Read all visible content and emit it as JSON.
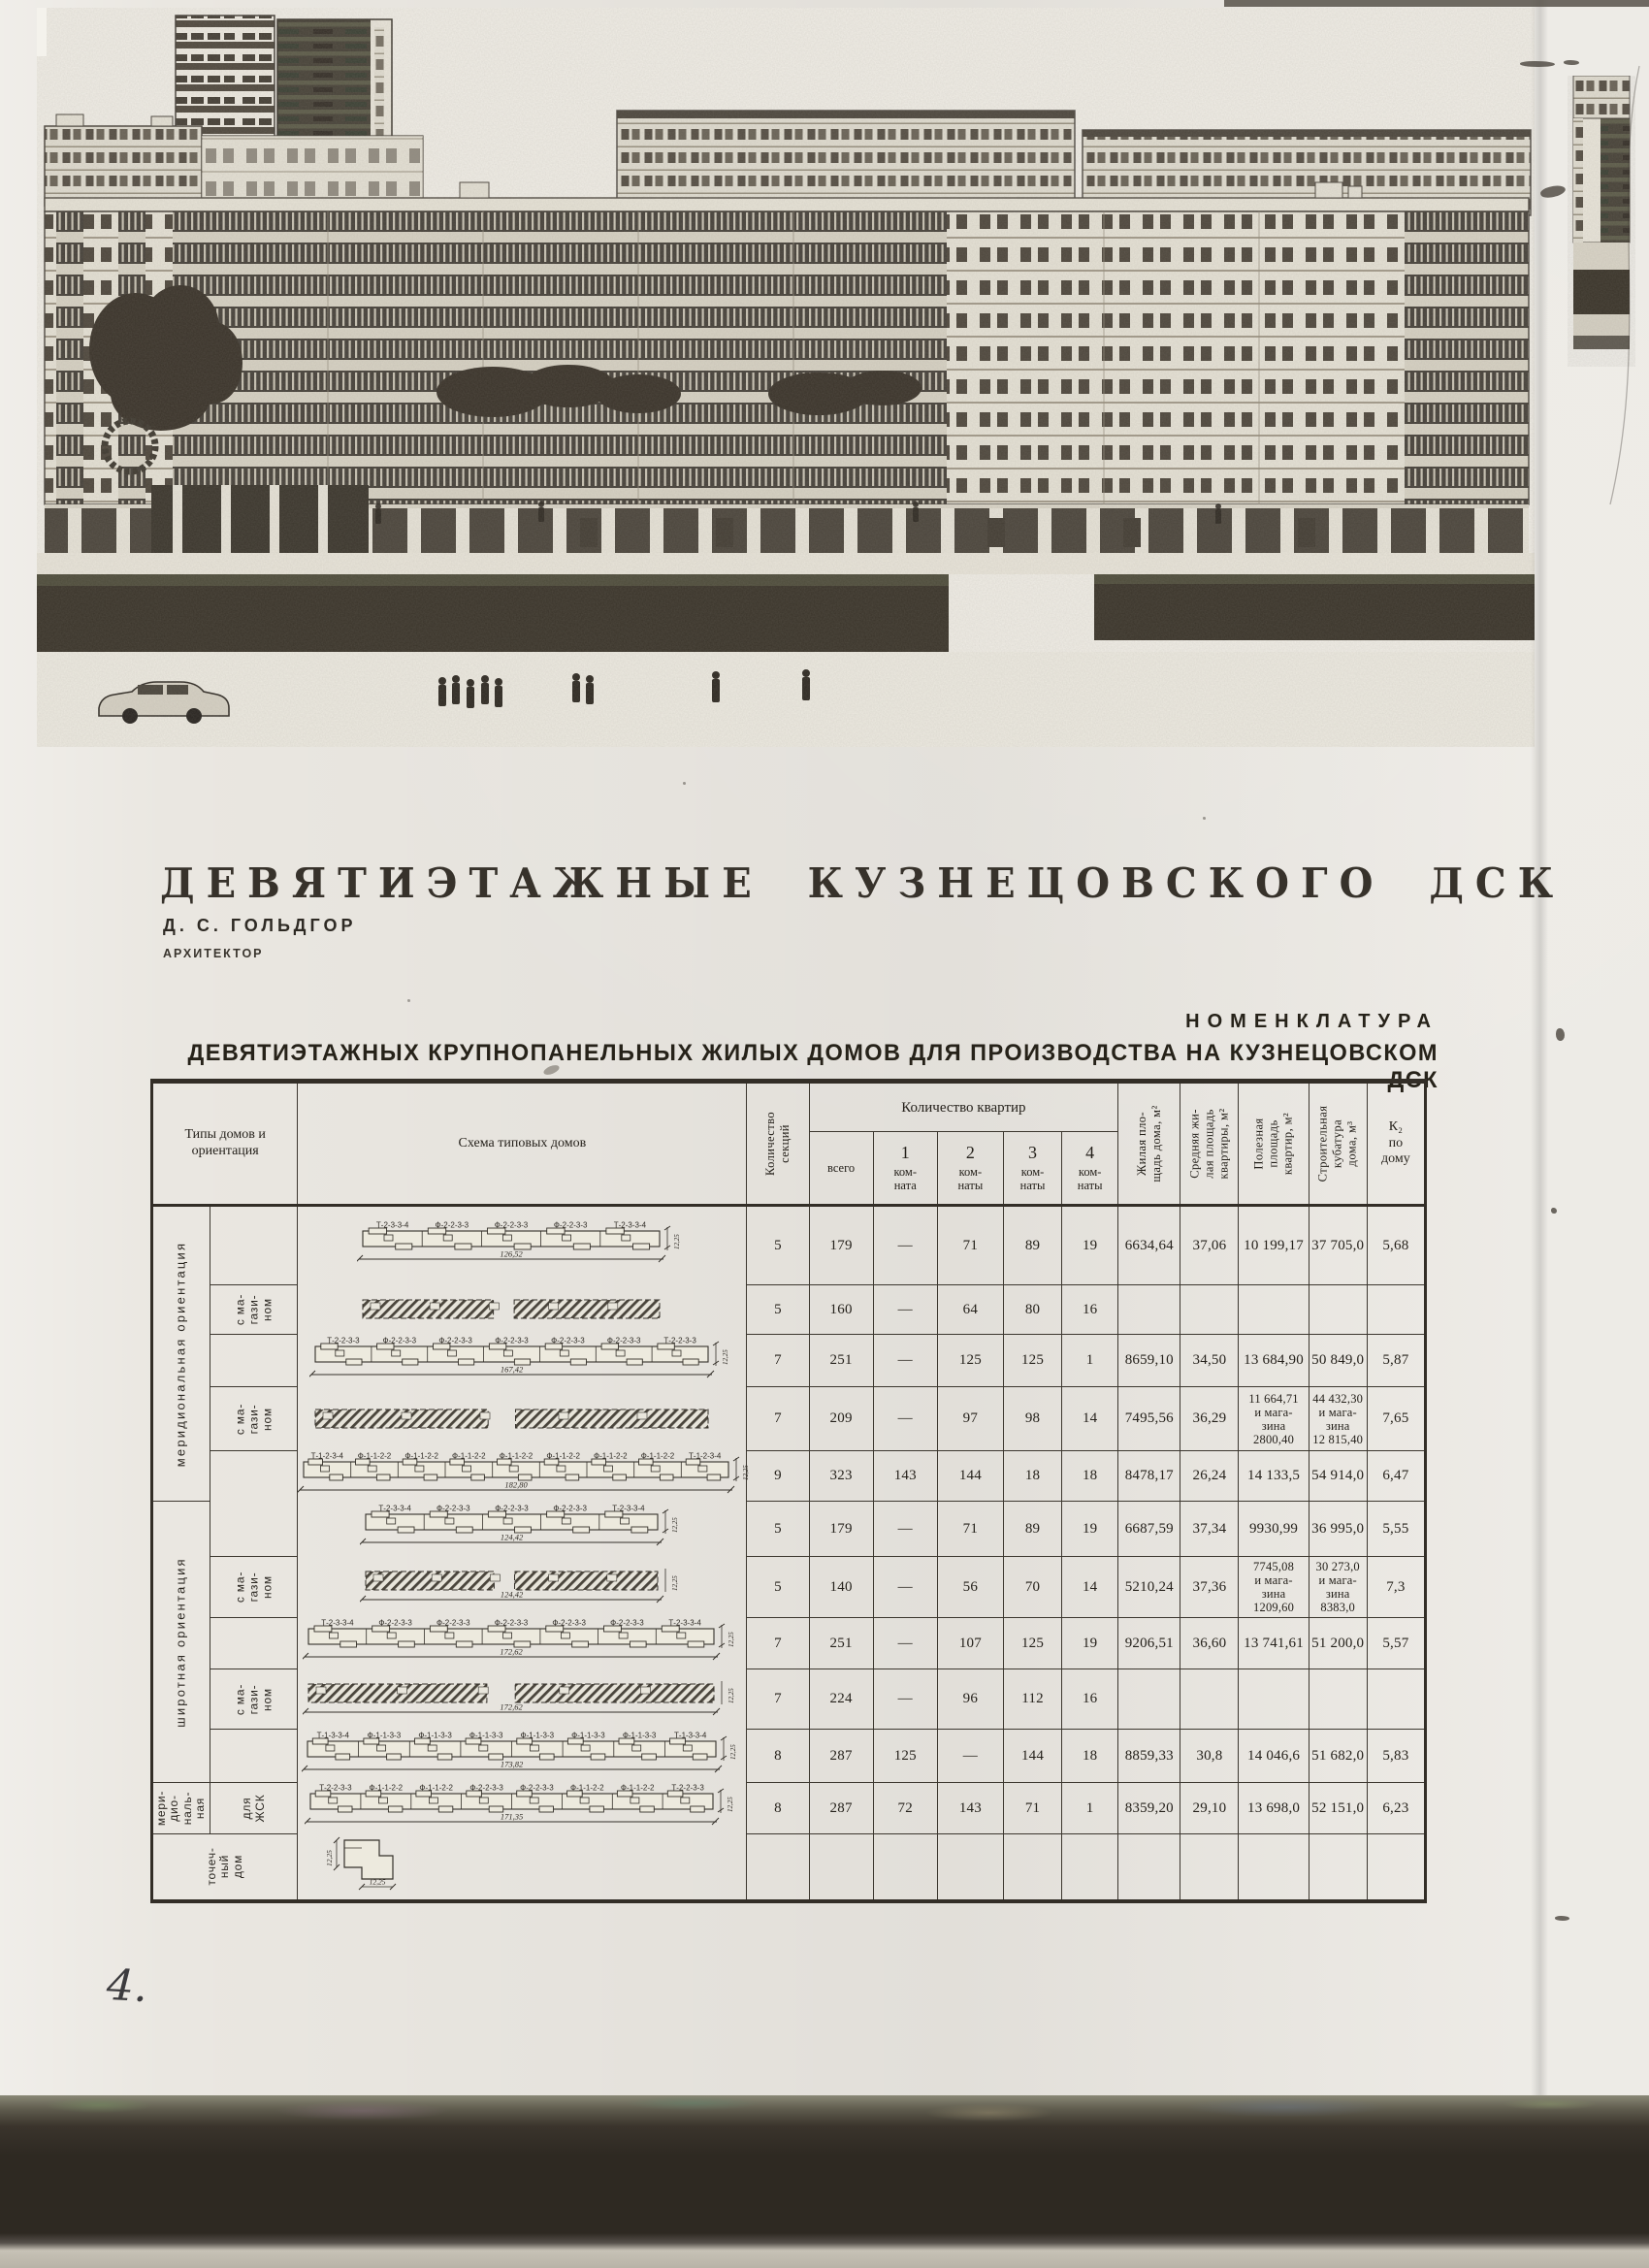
{
  "page": {
    "handwritten_number": "4.",
    "colors": {
      "paper": "#eae7e1",
      "ink": "#2c2824",
      "table_line": "#3c372f",
      "scan_band": "#2e2922",
      "photo_dark": "#46413a",
      "photo_light": "#e6e2d6"
    }
  },
  "title": "ДЕВЯТИЭТАЖНЫЕ КУЗНЕЦОВСКОГО ДСК",
  "author": {
    "name": "Д. С. ГОЛЬДГОР",
    "role": "АРХИТЕКТОР"
  },
  "nomenclature": {
    "heading": "НОМЕНКЛАТУРА",
    "subheading": "ДЕВЯТИЭТАЖНЫХ КРУПНОПАНЕЛЬНЫХ ЖИЛЫХ ДОМОВ ДЛЯ ПРОИЗВОДСТВА НА КУЗНЕЦОВСКОМ ДСК"
  },
  "table": {
    "headers": {
      "types": "Типы домов и\nориентация",
      "scheme": "Схема типовых домов",
      "sections": "Количество\nсекций",
      "apartments_group": "Количество квартир",
      "apartments": [
        "всего",
        "1\nком-\nната",
        "2\nком-\nнаты",
        "3\nком-\nнаты",
        "4\nком-\nнаты"
      ],
      "living_area": "Жилая пло-\nщадь дома, м²",
      "avg_area": "Средняя жи-\nлая площадь\nквартиры, м²",
      "useful_area": "Полезная\nплощадь\nквартир, м²",
      "volume": "Строительная\nкубатура\nдома, м³",
      "k2": "К₂\nпо\nдому"
    },
    "groups": [
      {
        "label": "меридиональная ориентация",
        "rows": [
          0,
          4
        ]
      },
      {
        "label": "широтная ориентация",
        "rows": [
          5,
          9
        ]
      },
      {
        "label": "мери-\nдио-\nналь-\nная",
        "rows": [
          10,
          10
        ]
      },
      {
        "label": "точеч-\nный\nдом",
        "rows": [
          11,
          11
        ],
        "full": true
      }
    ],
    "rows": [
      {
        "sub": "",
        "scheme": {
          "kind": "plan",
          "labels": [
            "Т-2-3-3-4",
            "Ф-2-2-3-3",
            "Ф-2-2-3-3",
            "Ф-2-2-3-3",
            "Т-2-3-3-4"
          ],
          "length": "126,52",
          "depth": "12,25"
        },
        "values": [
          "5",
          "179",
          "—",
          "71",
          "89",
          "19",
          "6634,64",
          "37,06",
          "10 199,17",
          "37 705,0",
          "5,68"
        ]
      },
      {
        "sub": "с ма-\nгази-\nном",
        "scheme": {
          "kind": "hatched"
        },
        "values": [
          "5",
          "160",
          "—",
          "64",
          "80",
          "16",
          "",
          "",
          "",
          "",
          ""
        ]
      },
      {
        "sub": "",
        "scheme": {
          "kind": "plan",
          "labels": [
            "Т-2-2-3-3",
            "Ф-2-2-3-3",
            "Ф-2-2-3-3",
            "Ф-2-2-3-3",
            "Ф-2-2-3-3",
            "Ф-2-2-3-3",
            "Т-2-2-3-3"
          ],
          "length": "167,42",
          "depth": "12,25"
        },
        "values": [
          "7",
          "251",
          "—",
          "125",
          "125",
          "1",
          "8659,10",
          "34,50",
          "13 684,90",
          "50 849,0",
          "5,87"
        ]
      },
      {
        "sub": "с ма-\nгази-\nном",
        "scheme": {
          "kind": "hatched"
        },
        "values": [
          "7",
          "209",
          "—",
          "97",
          "98",
          "14",
          "7495,56",
          "36,29",
          "11 664,71\nи мага-\nзина\n2800,40",
          "44 432,30\nи мага-\nзина\n12 815,40",
          "7,65"
        ]
      },
      {
        "sub": "",
        "scheme": {
          "kind": "plan",
          "labels": [
            "Т-1-2-3-4",
            "Ф-1-1-2-2",
            "Ф-1-1-2-2",
            "Ф-1-1-2-2",
            "Ф-1-1-2-2",
            "Ф-1-1-2-2",
            "Ф-1-1-2-2",
            "Ф-1-1-2-2",
            "Т-1-2-3-4"
          ],
          "length": "182,80",
          "depth": "12,25"
        },
        "values": [
          "9",
          "323",
          "143",
          "144",
          "18",
          "18",
          "8478,17",
          "26,24",
          "14 133,5",
          "54 914,0",
          "6,47"
        ]
      },
      {
        "sub": "",
        "scheme": {
          "kind": "plan",
          "labels": [
            "Т-2-3-3-4",
            "Ф-2-2-3-3",
            "Ф-2-2-3-3",
            "Ф-2-2-3-3",
            "Т-2-3-3-4"
          ],
          "length": "124,42",
          "depth": "12,25"
        },
        "values": [
          "5",
          "179",
          "—",
          "71",
          "89",
          "19",
          "6687,59",
          "37,34",
          "9930,99",
          "36 995,0",
          "5,55"
        ]
      },
      {
        "sub": "с ма-\nгази-\nном",
        "scheme": {
          "kind": "hatched",
          "length": "124,42",
          "depth": "12,25"
        },
        "values": [
          "5",
          "140",
          "—",
          "56",
          "70",
          "14",
          "5210,24",
          "37,36",
          "7745,08\nи мага-\nзина\n1209,60",
          "30 273,0\nи мага-\nзина\n8383,0",
          "7,3"
        ]
      },
      {
        "sub": "",
        "scheme": {
          "kind": "plan",
          "labels": [
            "Т-2-3-3-4",
            "Ф-2-2-3-3",
            "Ф-2-2-3-3",
            "Ф-2-2-3-3",
            "Ф-2-2-3-3",
            "Ф-2-2-3-3",
            "Т-2-3-3-4"
          ],
          "length": "172,62",
          "depth": "12,25"
        },
        "values": [
          "7",
          "251",
          "—",
          "107",
          "125",
          "19",
          "9206,51",
          "36,60",
          "13 741,61",
          "51 200,0",
          "5,57"
        ]
      },
      {
        "sub": "с ма-\nгази-\nном",
        "scheme": {
          "kind": "hatched",
          "length": "172,62",
          "depth": "12,25"
        },
        "values": [
          "7",
          "224",
          "—",
          "96",
          "112",
          "16",
          "",
          "",
          "",
          "",
          ""
        ]
      },
      {
        "sub": "",
        "scheme": {
          "kind": "plan",
          "labels": [
            "Т-1-3-3-4",
            "Ф-1-1-3-3",
            "Ф-1-1-3-3",
            "Ф-1-1-3-3",
            "Ф-1-1-3-3",
            "Ф-1-1-3-3",
            "Ф-1-1-3-3",
            "Т-1-3-3-4"
          ],
          "length": "173,82",
          "depth": "12,25"
        },
        "values": [
          "8",
          "287",
          "125",
          "—",
          "144",
          "18",
          "8859,33",
          "30,8",
          "14 046,6",
          "51 682,0",
          "5,83"
        ]
      },
      {
        "sub": "для\nЖСК",
        "scheme": {
          "kind": "plan",
          "labels": [
            "Т-2-2-3-3",
            "Ф-1-1-2-2",
            "Ф-1-1-2-2",
            "Ф-2-2-3-3",
            "Ф-2-2-3-3",
            "Ф-1-1-2-2",
            "Ф-1-1-2-2",
            "Т-2-2-3-3"
          ],
          "length": "171,35",
          "depth": "12,25"
        },
        "values": [
          "8",
          "287",
          "72",
          "143",
          "71",
          "1",
          "8359,20",
          "29,10",
          "13 698,0",
          "52 151,0",
          "6,23"
        ]
      },
      {
        "sub": null,
        "scheme": {
          "kind": "point",
          "width_label": "12,25",
          "height_label": "12,25"
        },
        "values": [
          "",
          "",
          "",
          "",
          "",
          "",
          "",
          "",
          "",
          "",
          ""
        ]
      }
    ]
  }
}
